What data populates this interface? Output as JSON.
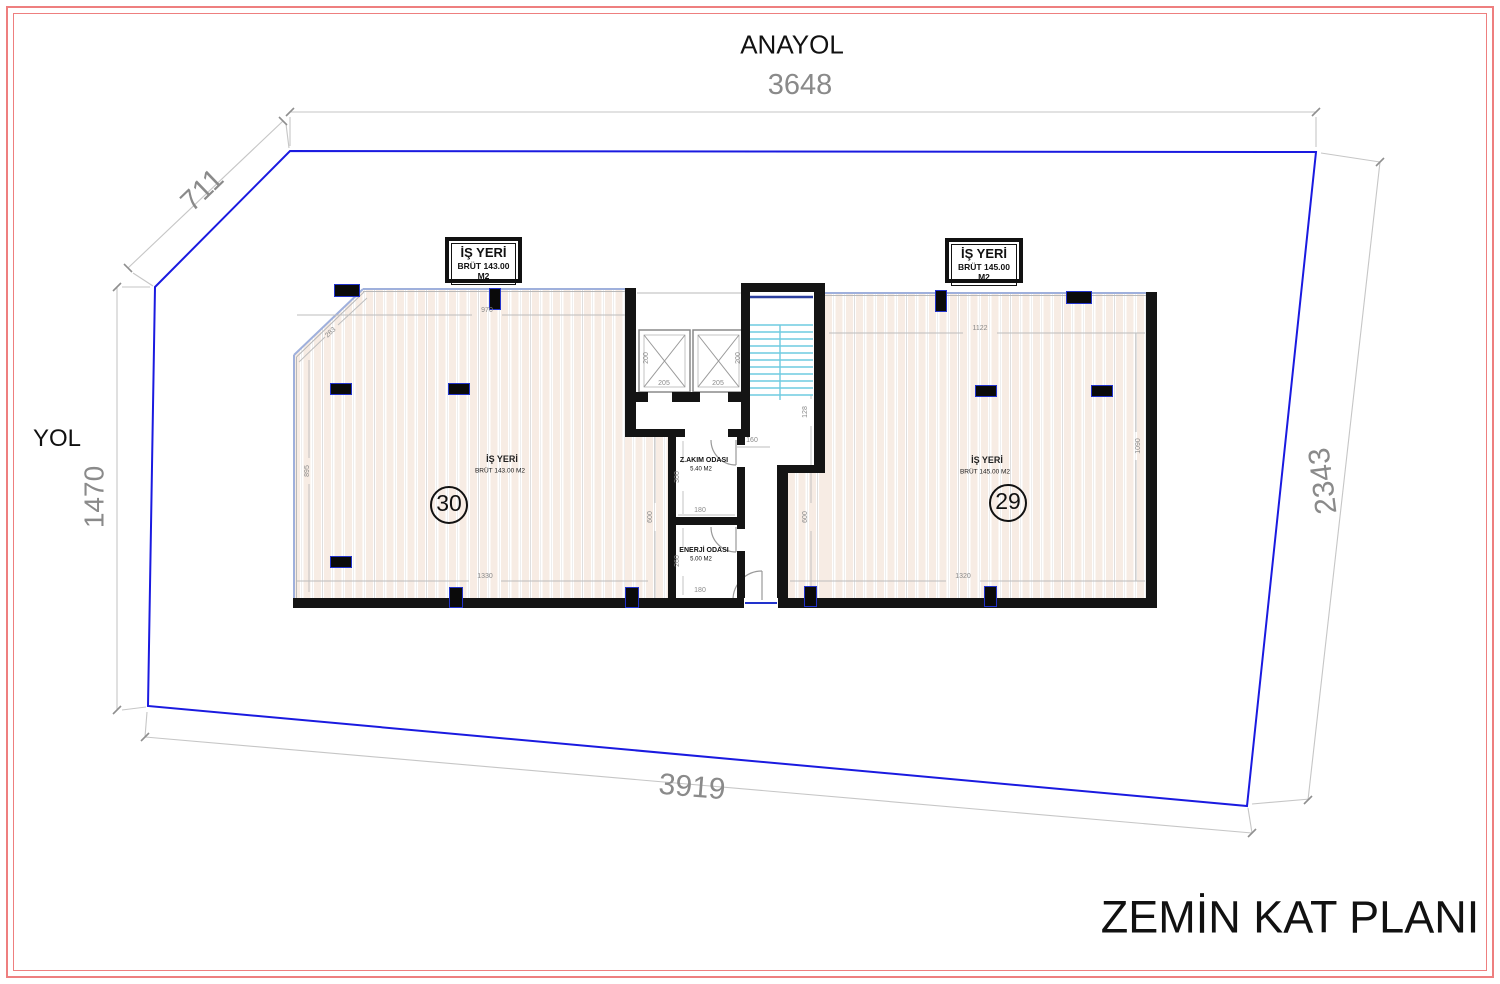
{
  "drawing_title": "ZEMİN KAT PLANI",
  "roads": {
    "top_label": "ANAYOL",
    "left_label": "YOL"
  },
  "site_dims": {
    "top": "3648",
    "diagonal": "711",
    "left": "1470",
    "right": "2343",
    "bottom": "3919"
  },
  "unit30": {
    "tag_title": "İŞ YERİ",
    "tag_area": "BRÜT 143.00 M2",
    "floor_label": "İŞ YERİ",
    "floor_area": "BRÜT 143.00 M2",
    "number": "30",
    "dim_top": "970",
    "dim_bottom": "1330",
    "dim_left": "895",
    "dim_diagonal": "283",
    "dim_core_side": "600"
  },
  "unit29": {
    "tag_title": "İŞ YERİ",
    "tag_area": "BRÜT 145.00 M2",
    "floor_label": "İŞ YERİ",
    "floor_area": "BRÜT 145.00 M2",
    "number": "29",
    "dim_top": "1122",
    "dim_bottom": "1320",
    "dim_right": "1090",
    "dim_core_side": "600"
  },
  "core": {
    "elevator1_width": "205",
    "elevator2_width": "205",
    "elevator1_depth": "200",
    "elevator2_depth": "200",
    "stair_dim": "128",
    "corridor_dim": "160"
  },
  "rooms": {
    "zakim": {
      "name": "Z.AKIM ODASI",
      "area": "5.40 M2",
      "dim_height": "300",
      "dim_width": "180"
    },
    "enerji": {
      "name": "ENERJİ ODASI",
      "area": "5.00 M2",
      "dim_height": "260",
      "dim_width": "180"
    }
  },
  "colors": {
    "frame_red": "#ee7f7f",
    "boundary_blue": "#1a1ae0",
    "stair_cyan": "#6fcbe0",
    "column_outline_blue": "#2233cc",
    "dimension_gray": "#8a8a8a",
    "wall_black": "#141414",
    "floor_stripe": "#f7ece4"
  }
}
